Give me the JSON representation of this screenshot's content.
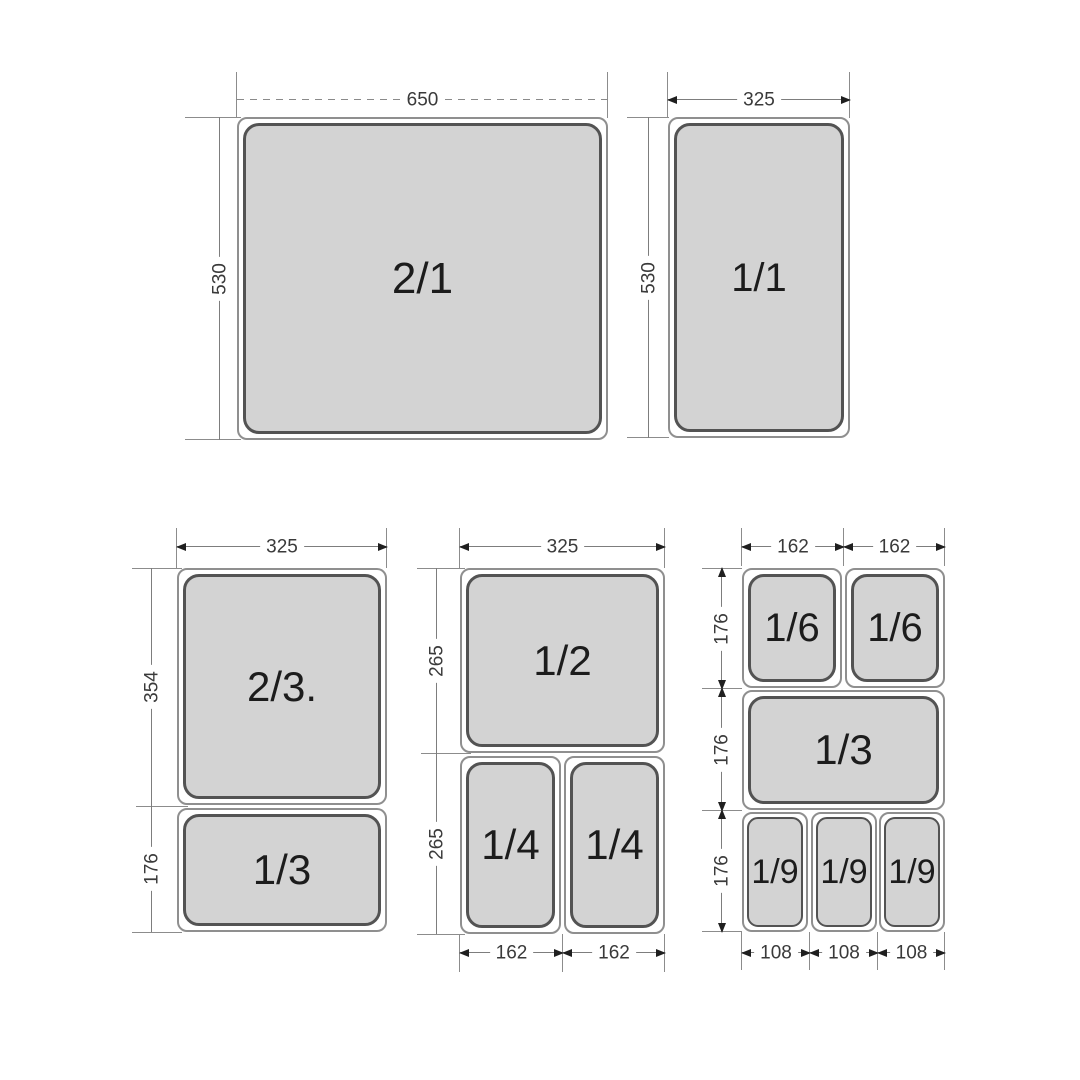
{
  "gn_2_1": {
    "pan_label": "2/1",
    "width": "650",
    "height": "530"
  },
  "gn_1_1": {
    "pan_label": "1/1",
    "width": "325",
    "height": "530"
  },
  "left_group": {
    "width": "325",
    "top_pan_label": "2/3.",
    "top_pan_height": "354",
    "bottom_pan_label": "1/3",
    "bottom_pan_height": "176"
  },
  "middle_group": {
    "width": "325",
    "half_pan_label": "1/2",
    "half_row_height": "265",
    "quarter_pan_label_1": "1/4",
    "quarter_pan_label_2": "1/4",
    "quarter_row_height": "265",
    "quarter_pan_width_1": "162",
    "quarter_pan_width_2": "162"
  },
  "right_group": {
    "sixth_pan_width_1": "162",
    "sixth_pan_width_2": "162",
    "sixth_pan_label_1": "1/6",
    "sixth_pan_label_2": "1/6",
    "sixth_row_height": "176",
    "third_pan_label": "1/3",
    "third_row_height": "176",
    "ninth_pan_label_1": "1/9",
    "ninth_pan_label_2": "1/9",
    "ninth_pan_label_3": "1/9",
    "ninth_row_height": "176",
    "ninth_pan_width_1": "108",
    "ninth_pan_width_2": "108",
    "ninth_pan_width_3": "108"
  },
  "colors": {
    "pan_fill": "#d3d3d3",
    "pan_rim_outline": "#8f8f8f",
    "pan_inner_outline": "#535353",
    "dimension_line": "#7d7d7d",
    "label_text": "#1c1c1c",
    "dimension_text": "#3a3a3a"
  }
}
